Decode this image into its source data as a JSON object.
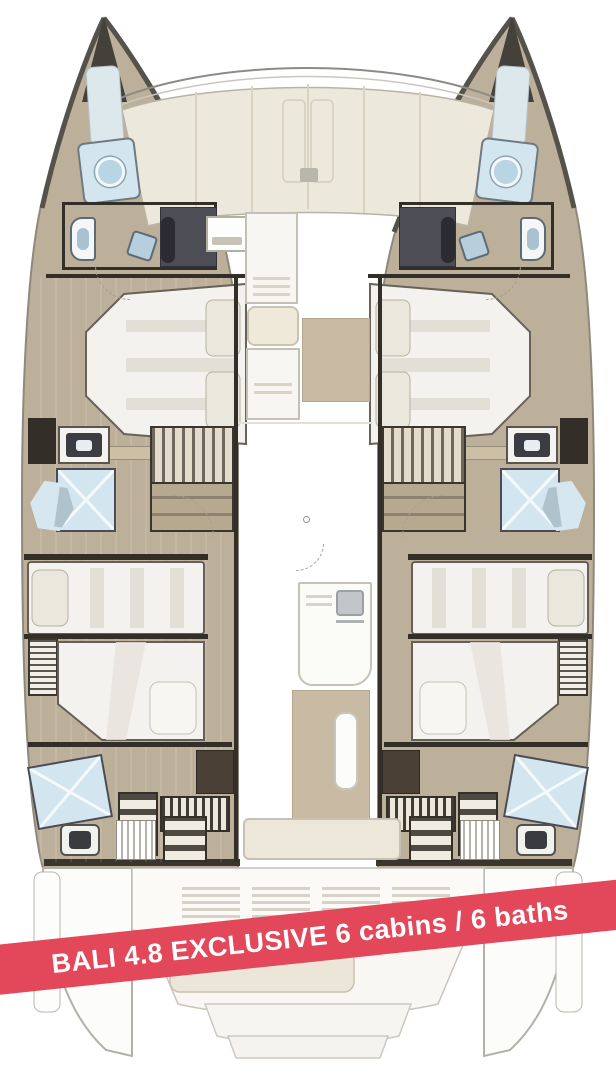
{
  "banner": {
    "text": "BALI 4.8 EXCLUSIVE 6 cabins / 6 baths"
  },
  "model": {
    "name": "BALI 4.8 EXCLUSIVE",
    "cabins": "6",
    "baths": "6",
    "view": "deck floor plan, top view"
  },
  "colors": {
    "accent": "#e2475a",
    "deck_cream": "#ece8db",
    "hull_floor": "#bdb09a",
    "wall_dark": "#332e27",
    "shower_blue": "#d3e5ee",
    "panel_gray": "#4d4e55",
    "rug_tan": "#c9bba3",
    "bed_white": "#f3f2ef",
    "outline_gray": "#8f897d"
  },
  "legend": {
    "port_hull_rooms": [
      "bow-shower-room",
      "forward-wc",
      "forward-double-cabin",
      "midship-bathroom",
      "companionway-stairs",
      "aft-double-cabin-forward",
      "aft-double-cabin-aft",
      "aft-bathroom",
      "aft-steps"
    ],
    "starboard_hull_rooms": [
      "bow-shower-room",
      "forward-wc",
      "forward-double-cabin",
      "midship-bathroom",
      "companionway-stairs",
      "aft-double-cabin-forward",
      "aft-double-cabin-aft",
      "aft-bathroom",
      "aft-steps"
    ],
    "center_items": [
      "foredeck-lounge",
      "anchor-locker",
      "forward-cockpit-seating",
      "forward-cockpit-rug",
      "galley-island",
      "saloon-rug",
      "saloon-table",
      "aft-cockpit-bench",
      "transom-vents",
      "swim-platform-steps",
      "dinghy-pad"
    ]
  }
}
